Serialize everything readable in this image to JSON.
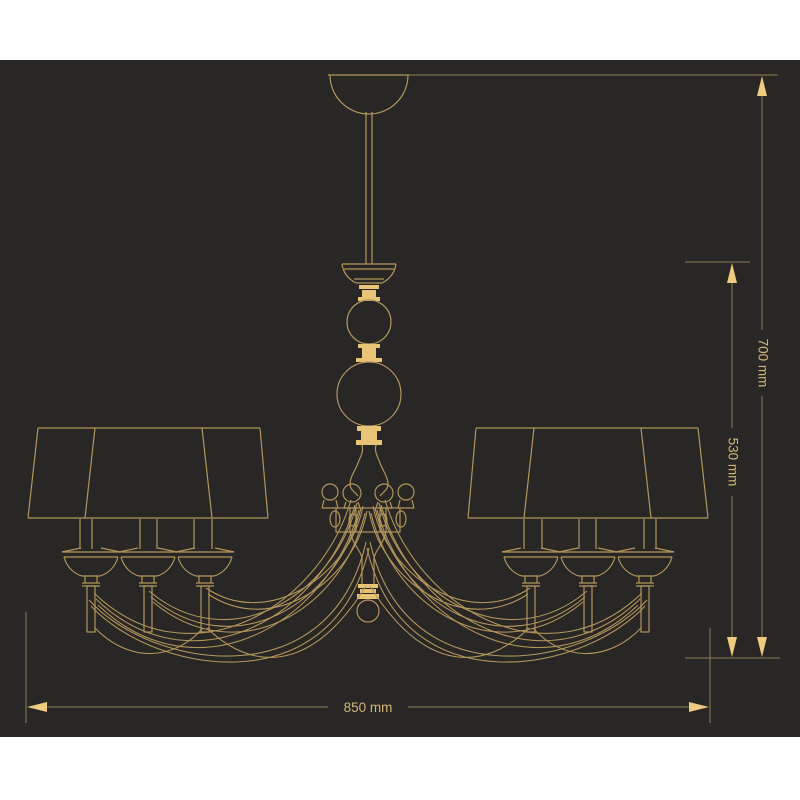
{
  "page": {
    "background": "#ffffff",
    "canvas_background": "#282725"
  },
  "diagram": {
    "type": "technical-line-drawing",
    "subject": "six-arm chandelier with tapered shades, front elevation with dimensions",
    "line_color": "#b2955c",
    "fill_accent_color": "#e9c476",
    "dimension_line_color": "#8d7d4e",
    "dimension_text_color": "#d3b577",
    "labels": {
      "height_total": "700 mm",
      "height_body": "530 mm",
      "width_total": "850 mm"
    },
    "dimensions": [
      {
        "id": "total-height",
        "value": 700,
        "unit": "mm",
        "orientation": "vertical"
      },
      {
        "id": "body-height",
        "value": 530,
        "unit": "mm",
        "orientation": "vertical"
      },
      {
        "id": "total-width",
        "value": 850,
        "unit": "mm",
        "orientation": "horizontal"
      }
    ]
  }
}
